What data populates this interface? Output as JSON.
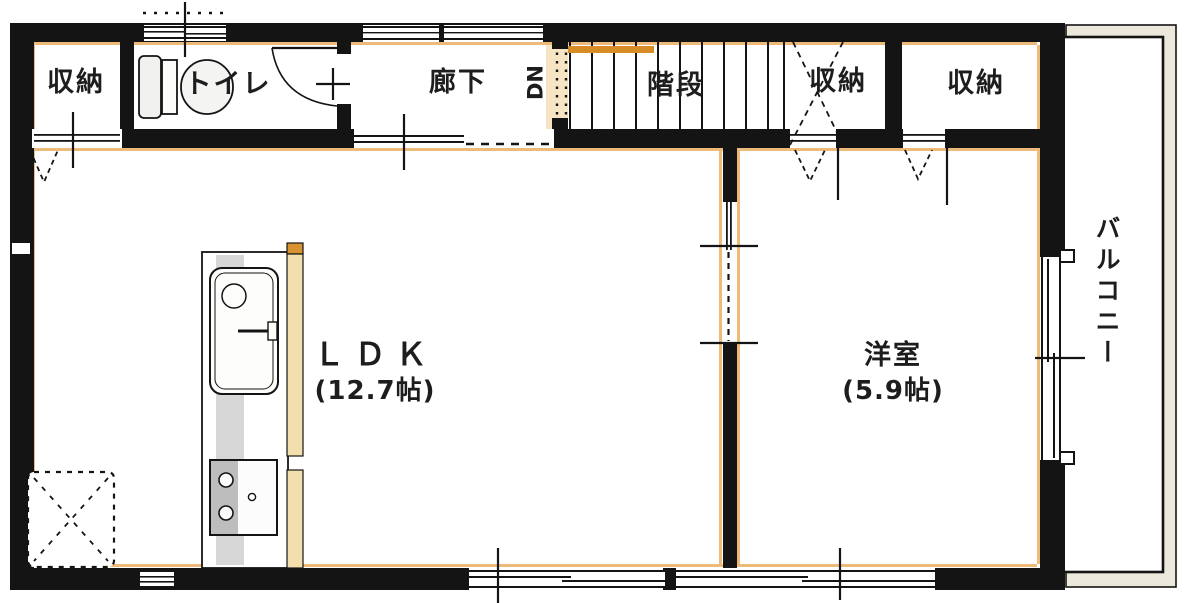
{
  "plan": {
    "type": "japanese-floor-plan",
    "rooms": {
      "closet_a": {
        "label": "収納"
      },
      "toilet": {
        "label": "トイレ"
      },
      "hallway": {
        "label": "廊下"
      },
      "stairs": {
        "label": "階段",
        "direction_marker": "DN"
      },
      "closet_b": {
        "label": "収納"
      },
      "closet_c": {
        "label": "収納"
      },
      "ldk": {
        "label": "ＬＤＫ",
        "area": "(12.7帖)"
      },
      "western_room": {
        "label": "洋室",
        "area": "(5.9帖)"
      },
      "balcony": {
        "label": "バルコニー"
      }
    },
    "colors": {
      "wall": "#141414",
      "accent_trim": "#ecb36b",
      "stair_handrail": "#d78c28",
      "stair_landing": "#f6e4c4",
      "counter_edge_tan": "#f3dfae",
      "counter_edge_cap": "#d8922f",
      "fixture_gray": "#d7d7d7",
      "balcony_trim_fill": "#ece8db"
    }
  }
}
